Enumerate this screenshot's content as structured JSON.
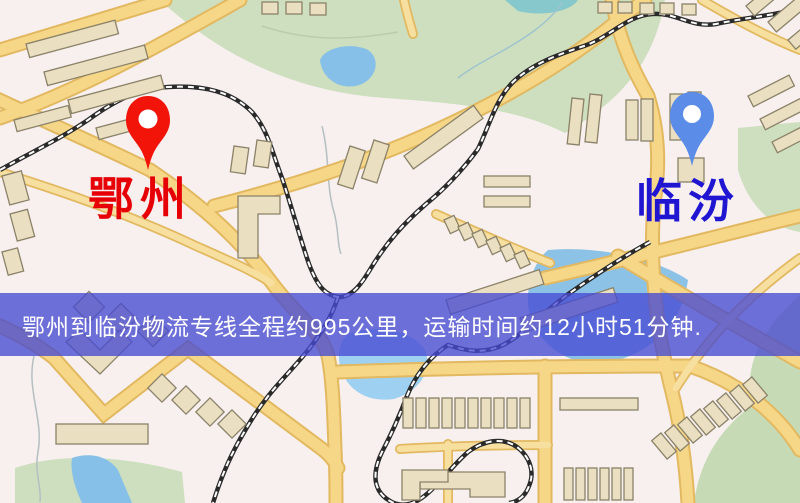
{
  "map": {
    "origin": {
      "name": "鄂州",
      "label_color": "#e60005",
      "marker": {
        "icon": "red-location-pin",
        "color": "#f21309"
      }
    },
    "destination": {
      "name": "临汾",
      "label_color": "#2016d2",
      "marker": {
        "icon": "blue-location-pin",
        "color": "#5a8ce8"
      }
    },
    "banner": {
      "text": "鄂州到临汾物流专线全程约995公里，运输时间约12小时51分钟.",
      "background": "rgba(70,74,210,0.78)",
      "text_color": "#ffffff"
    },
    "route": {
      "from": "鄂州",
      "to": "临汾",
      "service": "物流专线",
      "distance_text": "约995公里",
      "duration_text": "约12小时51分钟"
    },
    "legend_colors": {
      "road": "#f6d788",
      "road_casing": "#e2b860",
      "park": "#cddfbe",
      "water": "#86c0e8",
      "building": "#eadfc0",
      "railway": "#2a2a2a",
      "background": "#f7f0ee"
    }
  }
}
